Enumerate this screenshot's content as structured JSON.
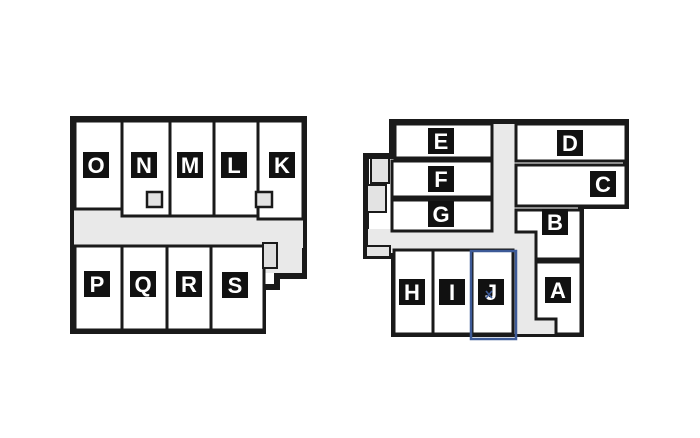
{
  "canvas": {
    "width": 700,
    "height": 438,
    "background": "#ffffff"
  },
  "colors": {
    "wall": "#1a1a1a",
    "room_fill": "#ffffff",
    "corridor_fill": "#e9e9e9",
    "stair_fill": "#e3e3e3",
    "vestibule_fill": "#dedede",
    "label_bg": "#111111",
    "label_text": "#ffffff",
    "selection_blue": "#3d5a97",
    "page_bg": "#ffffff"
  },
  "left_building": {
    "name": "left-floorplan",
    "top_row": [
      {
        "label": "O"
      },
      {
        "label": "N"
      },
      {
        "label": "M"
      },
      {
        "label": "L"
      },
      {
        "label": "K"
      }
    ],
    "bottom_row": [
      {
        "label": "P"
      },
      {
        "label": "Q"
      },
      {
        "label": "R"
      },
      {
        "label": "S"
      }
    ]
  },
  "right_building": {
    "name": "right-floorplan",
    "west_rooms": [
      {
        "label": "E"
      },
      {
        "label": "F"
      },
      {
        "label": "G"
      }
    ],
    "east_rooms": [
      {
        "label": "D"
      },
      {
        "label": "C"
      },
      {
        "label": "B"
      }
    ],
    "south_rooms": [
      {
        "label": "H"
      },
      {
        "label": "I"
      },
      {
        "label": "J"
      },
      {
        "label": "A"
      }
    ],
    "selected_room": "J"
  }
}
